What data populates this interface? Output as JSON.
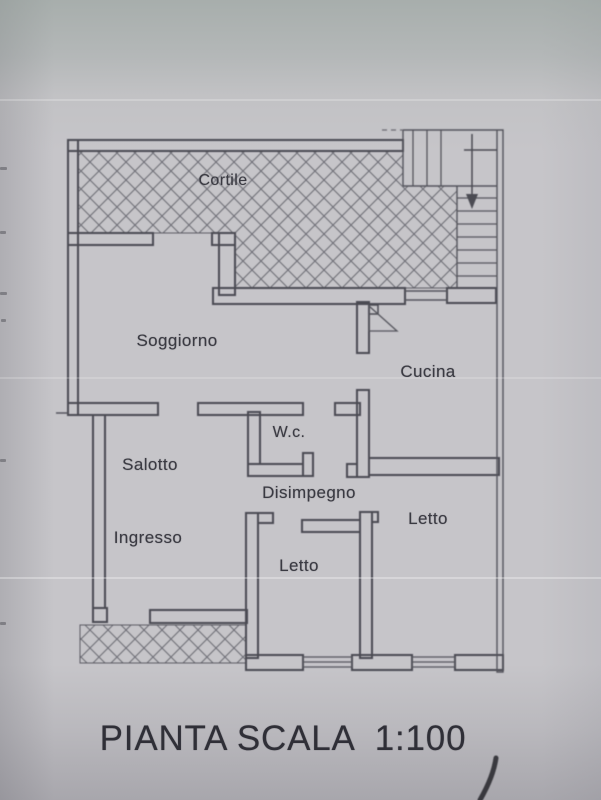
{
  "plan": {
    "title": "PIANTA SCALA  1:100",
    "scale": "1:100",
    "rooms": [
      {
        "id": "cortile",
        "label": "Cortile"
      },
      {
        "id": "soggiorno",
        "label": "Soggiorno"
      },
      {
        "id": "cucina",
        "label": "Cucina"
      },
      {
        "id": "wc",
        "label": "W.c."
      },
      {
        "id": "salotto",
        "label": "Salotto"
      },
      {
        "id": "disimpegno",
        "label": "Disimpegno"
      },
      {
        "id": "letto-destra",
        "label": "Letto"
      },
      {
        "id": "ingresso",
        "label": "Ingresso"
      },
      {
        "id": "letto-centro",
        "label": "Letto"
      }
    ]
  }
}
